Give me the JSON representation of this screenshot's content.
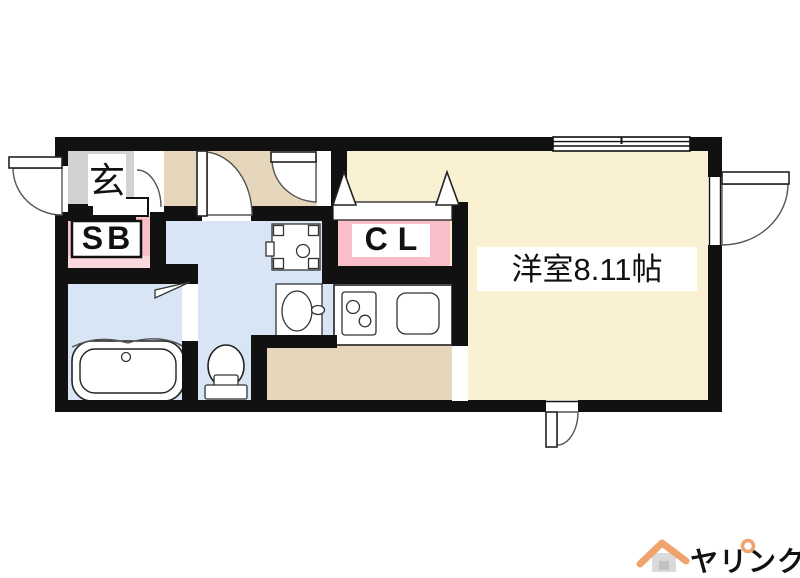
{
  "floorplan": {
    "labels": {
      "entrance": "玄",
      "shoe_box": "SB",
      "closet": "CL",
      "main_room": "洋室8.11帖"
    },
    "fixtures": [
      "bathtub",
      "toilet",
      "washbasin",
      "washing-machine-pan",
      "kitchen-stove",
      "kitchen-sink"
    ],
    "openings": [
      "entrance-door",
      "hall-doors",
      "bathroom-door",
      "closet-bifold-doors",
      "balcony-door",
      "small-rear-door",
      "top-window"
    ]
  },
  "logo": {
    "roof_char": "ヘ",
    "text": "ヤリンク"
  },
  "colors": {
    "wall": "#111111",
    "room_cream": "#FAF0D2",
    "floor_tan": "#E6D7BC",
    "wet_blue": "#D7E5F5",
    "entrance_gray": "#D2D2D2",
    "pink": "#F8BFC8",
    "pink_light": "#FBD8DD",
    "logo_orange": "#F0A36E",
    "logo_house_gray": "#DADADA",
    "logo_window_gray": "#C2C2C2"
  }
}
